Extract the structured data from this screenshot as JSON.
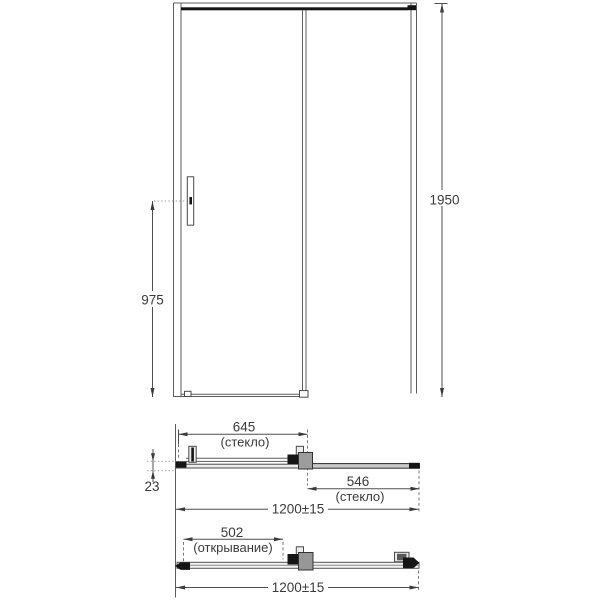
{
  "colors": {
    "background": "#ffffff",
    "line": "#5c5c5c",
    "dark_profile": "#151515",
    "text": "#3a3a3a"
  },
  "views": {
    "front_elevation": {
      "overall_height": "1950",
      "handle_center_height": "975"
    },
    "top_plan_section": {
      "sliding_glass_width": "645",
      "sliding_glass_note": "(стекло)",
      "profile_depth": "23",
      "fixed_glass_width": "546",
      "fixed_glass_note": "(стекло)",
      "overall_width": "1200±15"
    },
    "bottom_plan_section": {
      "opening_width": "502",
      "opening_note": "(открывание)",
      "overall_width": "1200±15"
    }
  }
}
